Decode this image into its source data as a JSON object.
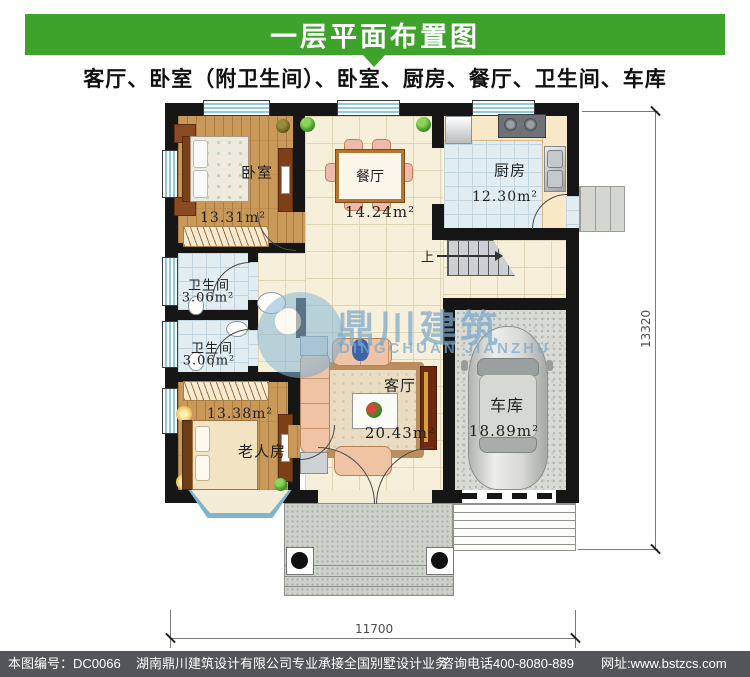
{
  "header": {
    "title": "一层平面布置图",
    "subtitle": "客厅、卧室（附卫生间）、卧室、厨房、餐厅、卫生间、车库"
  },
  "rooms": {
    "bedroom": {
      "label": "卧室",
      "area": "13.31m²"
    },
    "dining": {
      "label": "餐厅",
      "area": "14.24m²"
    },
    "kitchen": {
      "label": "厨房",
      "area": "12.30m²"
    },
    "bath1": {
      "label": "卫生间",
      "area": "3.06m²"
    },
    "bath2": {
      "label": "卫生间",
      "area": "3.06m²"
    },
    "elder": {
      "label": "老人房",
      "area": "13.38m²"
    },
    "living": {
      "label": "客厅",
      "area": "20.43m²"
    },
    "garage": {
      "label": "车库",
      "area": "18.89m²"
    }
  },
  "stairs": {
    "up_label": "上"
  },
  "dimensions": {
    "bottom_width": "11700",
    "right_height": "13320"
  },
  "watermark": {
    "cn": "鼎川建筑",
    "en": "DINGCHUAN JIANZHU"
  },
  "footer": {
    "plan_no": "本图编号：DC0066",
    "company": "湖南鼎川建筑设计有限公司专业承接全国别墅设计业务",
    "phone": "咨询电话400-8080-889",
    "website": "网址:www.bstzcs.com"
  },
  "colors": {
    "header_green": "#3EA32A",
    "footer_bg": "#545559",
    "wall_black": "#161616",
    "wood_floor": "#C9995A",
    "tile_cream": "#F6F0DA",
    "tile_blue": "#E2EDF2",
    "garage_gray": "#D8DBD5",
    "watermark_blue": "#7AA8CC",
    "window_blue": "#8EC9DD"
  }
}
